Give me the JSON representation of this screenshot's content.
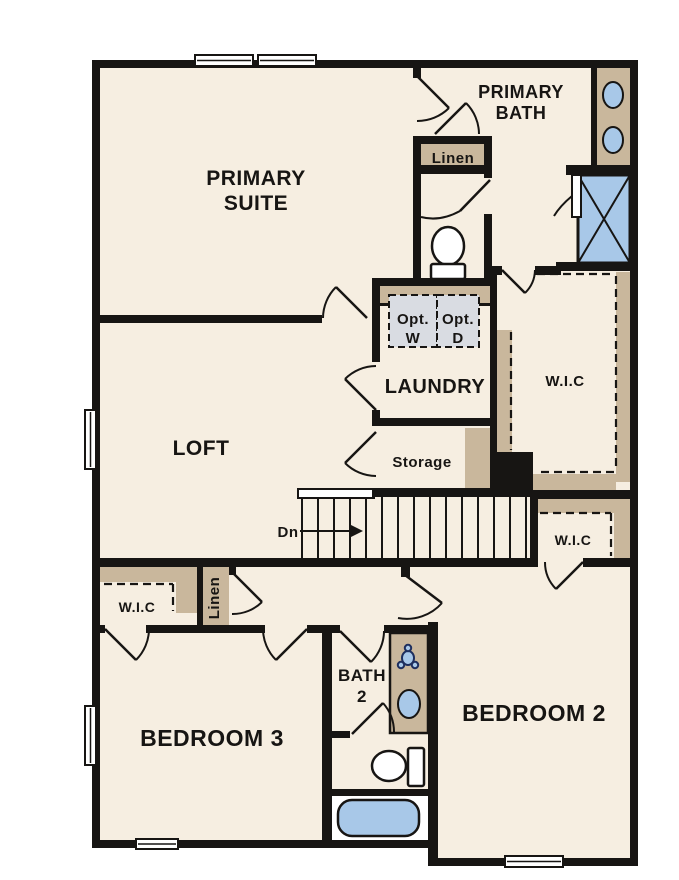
{
  "title": "Second Floor Plan",
  "colors": {
    "wall": "#171513",
    "floor": "#f6eee1",
    "tan": "#c9b79c",
    "blue": "#a8c8e8",
    "optbox": "#d9dce2",
    "icon_navy": "#1e2f5e",
    "text": "#171513"
  },
  "rooms": {
    "primary_suite": {
      "line1": "PRIMARY",
      "line2": "SUITE"
    },
    "primary_bath": {
      "line1": "PRIMARY",
      "line2": "BATH"
    },
    "loft": {
      "label": "LOFT"
    },
    "laundry": {
      "label": "LAUNDRY"
    },
    "storage": {
      "label": "Storage"
    },
    "wic_primary": {
      "label": "W.I.C"
    },
    "wic_hall": {
      "label": "W.I.C"
    },
    "wic_bed3": {
      "label": "W.I.C"
    },
    "linen_hall": {
      "label": "Linen"
    },
    "linen_bed3": {
      "label": "Linen"
    },
    "bath2": {
      "line1": "BATH",
      "line2": "2"
    },
    "bedroom2": {
      "label": "BEDROOM 2"
    },
    "bedroom3": {
      "label": "BEDROOM 3"
    }
  },
  "stairs": {
    "dn_label": "Dn"
  },
  "laundry_appliances": {
    "washer": {
      "line1": "Opt.",
      "line2": "W"
    },
    "dryer": {
      "line1": "Opt.",
      "line2": "D"
    }
  }
}
